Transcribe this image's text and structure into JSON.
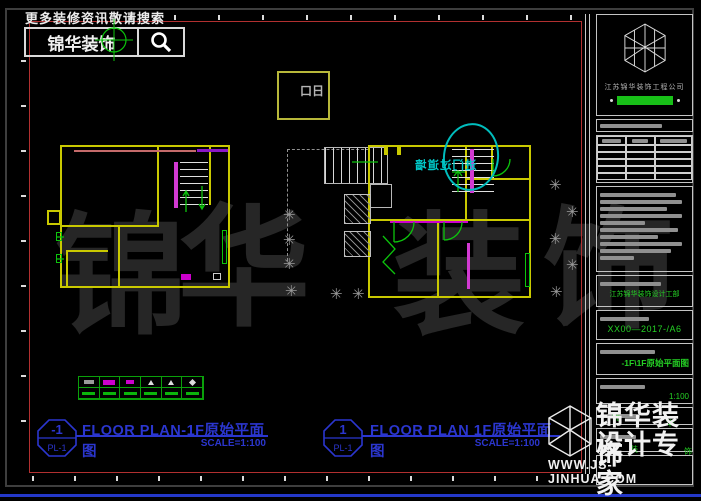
{
  "banner": {
    "text": "更多装修资讯敬请搜索"
  },
  "search": {
    "logo_text": "锦华装饰"
  },
  "top_box": {
    "text": "口日"
  },
  "annotation": {
    "entry_note": "进门过道墙"
  },
  "watermark": {
    "chars": [
      "锦",
      "华",
      "装",
      "饰"
    ]
  },
  "corner_logo": {
    "line1": "锦华装饰",
    "line2": "设计专家",
    "url": "WWW.JS-JINHUA.COM",
    "specks": [
      "锦",
      "华",
      "装",
      "饰"
    ]
  },
  "title_block": {
    "company": "江苏锦华装饰工程公司",
    "dept": "江苏锦华装饰设计工部",
    "project_no": "XX00—2017-/A6",
    "drawing_title": "-1F\\1F原始平面图",
    "scale": "1:100"
  },
  "labels": {
    "left": {
      "num": "-1",
      "ref": "PL-1",
      "title": "FLOOR PLAN-1F原始平面图",
      "scale": "SCALE=1:100"
    },
    "right": {
      "num": "1",
      "ref": "PL-1",
      "title": "FLOOR PLAN 1F原始平面图",
      "scale": "SCALE=1:100"
    }
  },
  "colors": {
    "wall": "#c9c900",
    "green": "#25d025",
    "magenta": "#cc00cc",
    "cyan": "#00c8c8",
    "frame_red": "#b23030",
    "label_blue": "#2b36cf"
  }
}
